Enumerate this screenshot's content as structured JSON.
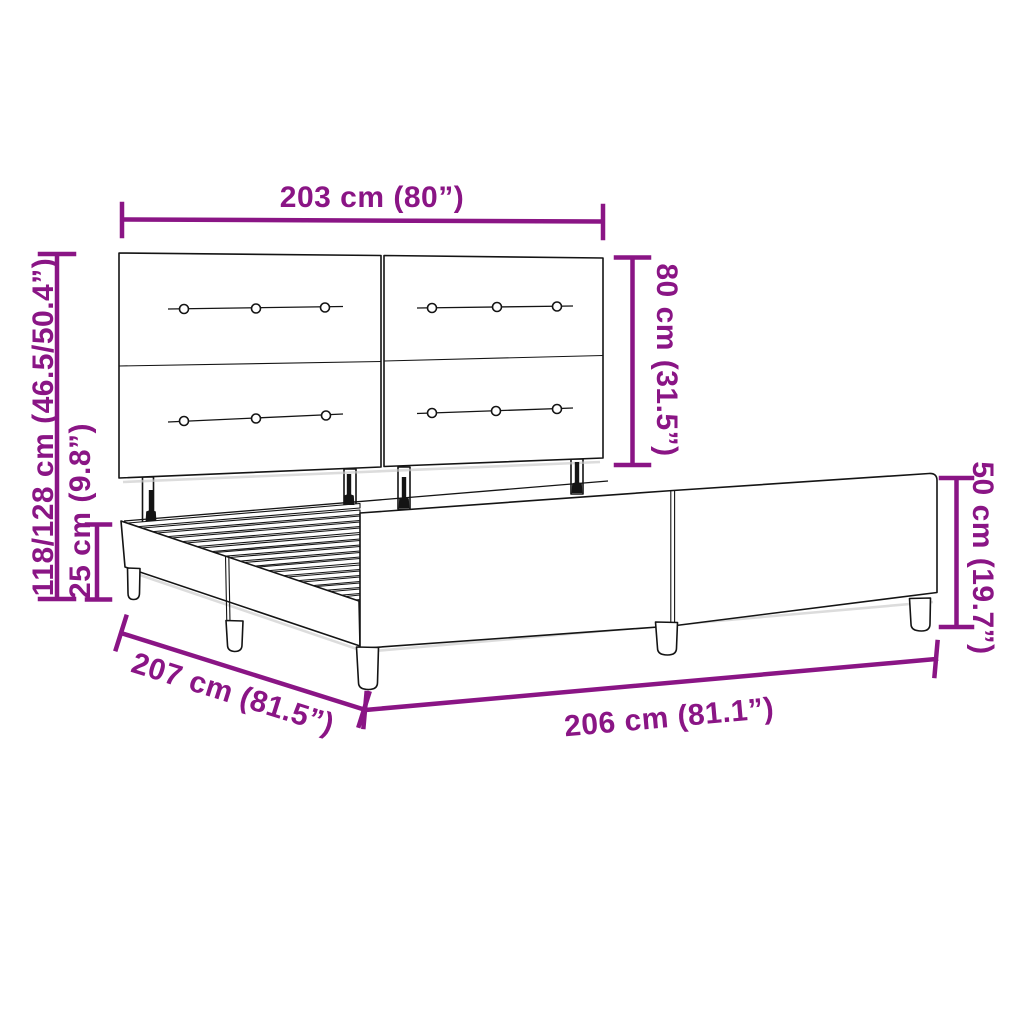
{
  "diagram": {
    "type": "product-dimension-diagram",
    "subject": "upholstered bed frame with tufted headboard, slatted base and side panels",
    "colors": {
      "dimension_accent": "#8A1585",
      "line": "#141414",
      "background": "#FFFFFF"
    },
    "dimensions": {
      "headboard_width": "203 cm (80”)",
      "headboard_height": "80 cm (31.5”)",
      "total_height": "118/128 cm (46.5/50.4”)",
      "base_height": "25 cm (9.8”)",
      "side_panel_height": "50 cm (19.7”)",
      "frame_depth": "207 cm (81.5”)",
      "frame_length": "206 cm (81.1”)"
    }
  }
}
